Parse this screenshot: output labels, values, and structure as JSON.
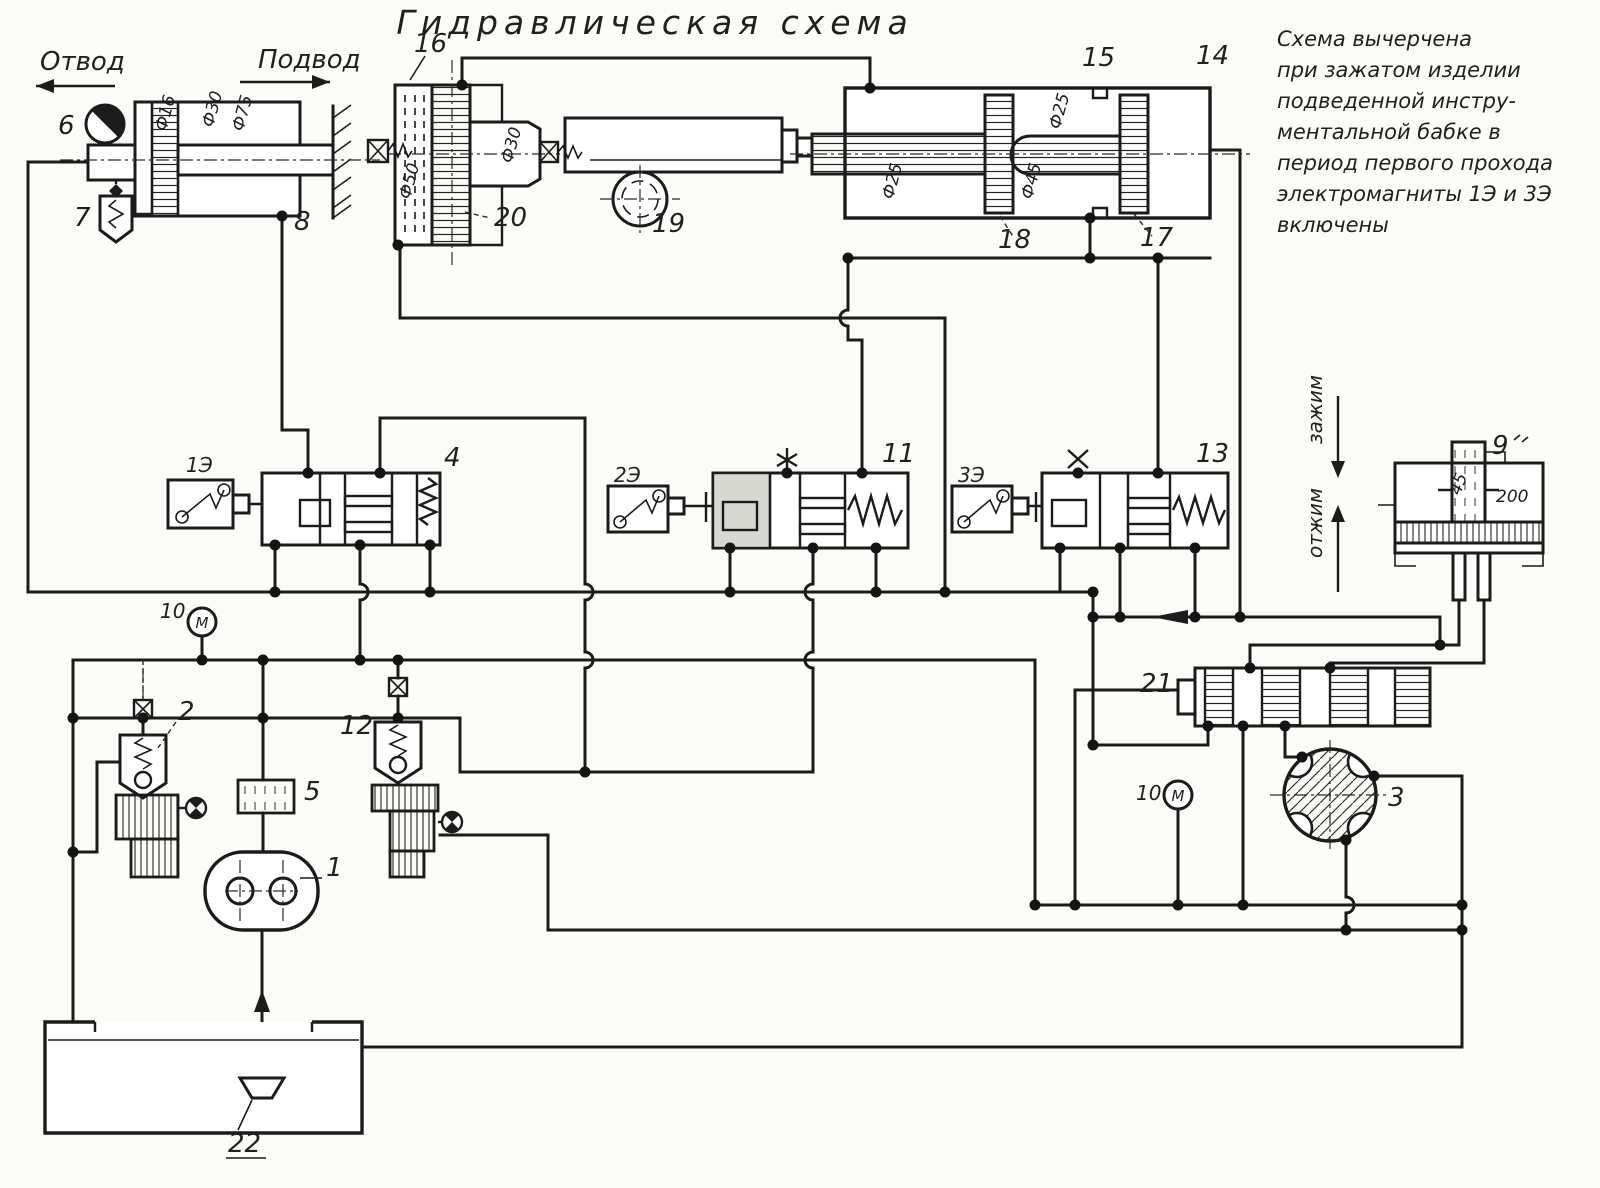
{
  "title": "Гидравлическая схема",
  "note": {
    "lines": [
      "Схема вычерчена",
      "при зажатом изделии",
      "подведенной инстру-",
      "ментальной бабке в",
      "период первого прохода",
      "электромагниты 1Э и 3Э",
      "включены"
    ]
  },
  "flow_labels": {
    "otvod": "Отвод",
    "podvod": "Подвод",
    "zazhim": "зажим",
    "otzhim": "отжим"
  },
  "solenoids": {
    "e1": "1Э",
    "e2": "2Э",
    "e3": "3Э"
  },
  "gauges": {
    "letter": "М"
  },
  "numbers": {
    "n1": "1",
    "n2": "2",
    "n3": "3",
    "n4": "4",
    "n5": "5",
    "n6": "6",
    "n7": "7",
    "n8": "8",
    "n9": "9",
    "n10": "10",
    "n11": "11",
    "n12": "12",
    "n13": "13",
    "n14": "14",
    "n15": "15",
    "n16": "16",
    "n17": "17",
    "n18": "18",
    "n19": "19",
    "n20": "20",
    "n21": "21",
    "n22": "22"
  },
  "dims": {
    "left_cyl_rod": "Ф16",
    "left_cyl_small": "Ф30",
    "left_cyl_bore": "Ф75",
    "cyl16_bore": "Ф50",
    "cyl16_rod": "Ф30",
    "right_cyl_rod": "Ф25",
    "right_cyl_mid": "Ф45",
    "right_cyl_top": "Ф25",
    "clamp_rod": "45",
    "clamp_bore": "200"
  }
}
